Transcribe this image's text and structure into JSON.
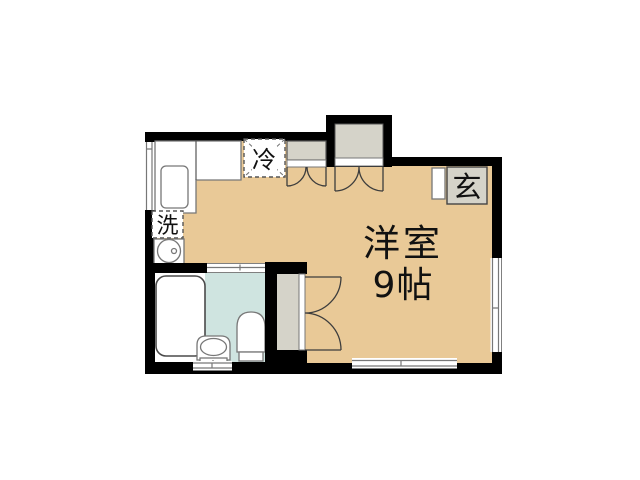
{
  "labels": {
    "room": "洋室",
    "room_size": "9帖",
    "entrance": "玄",
    "refrigerator": "冷",
    "washer": "洗"
  },
  "colors": {
    "background": "#ffffff",
    "wall": "#000000",
    "floor": "#e9c997",
    "closet_fill": "#d5d3c9",
    "entrance_fill": "#d5d3c9",
    "bath_floor": "#cfe4e0"
  }
}
